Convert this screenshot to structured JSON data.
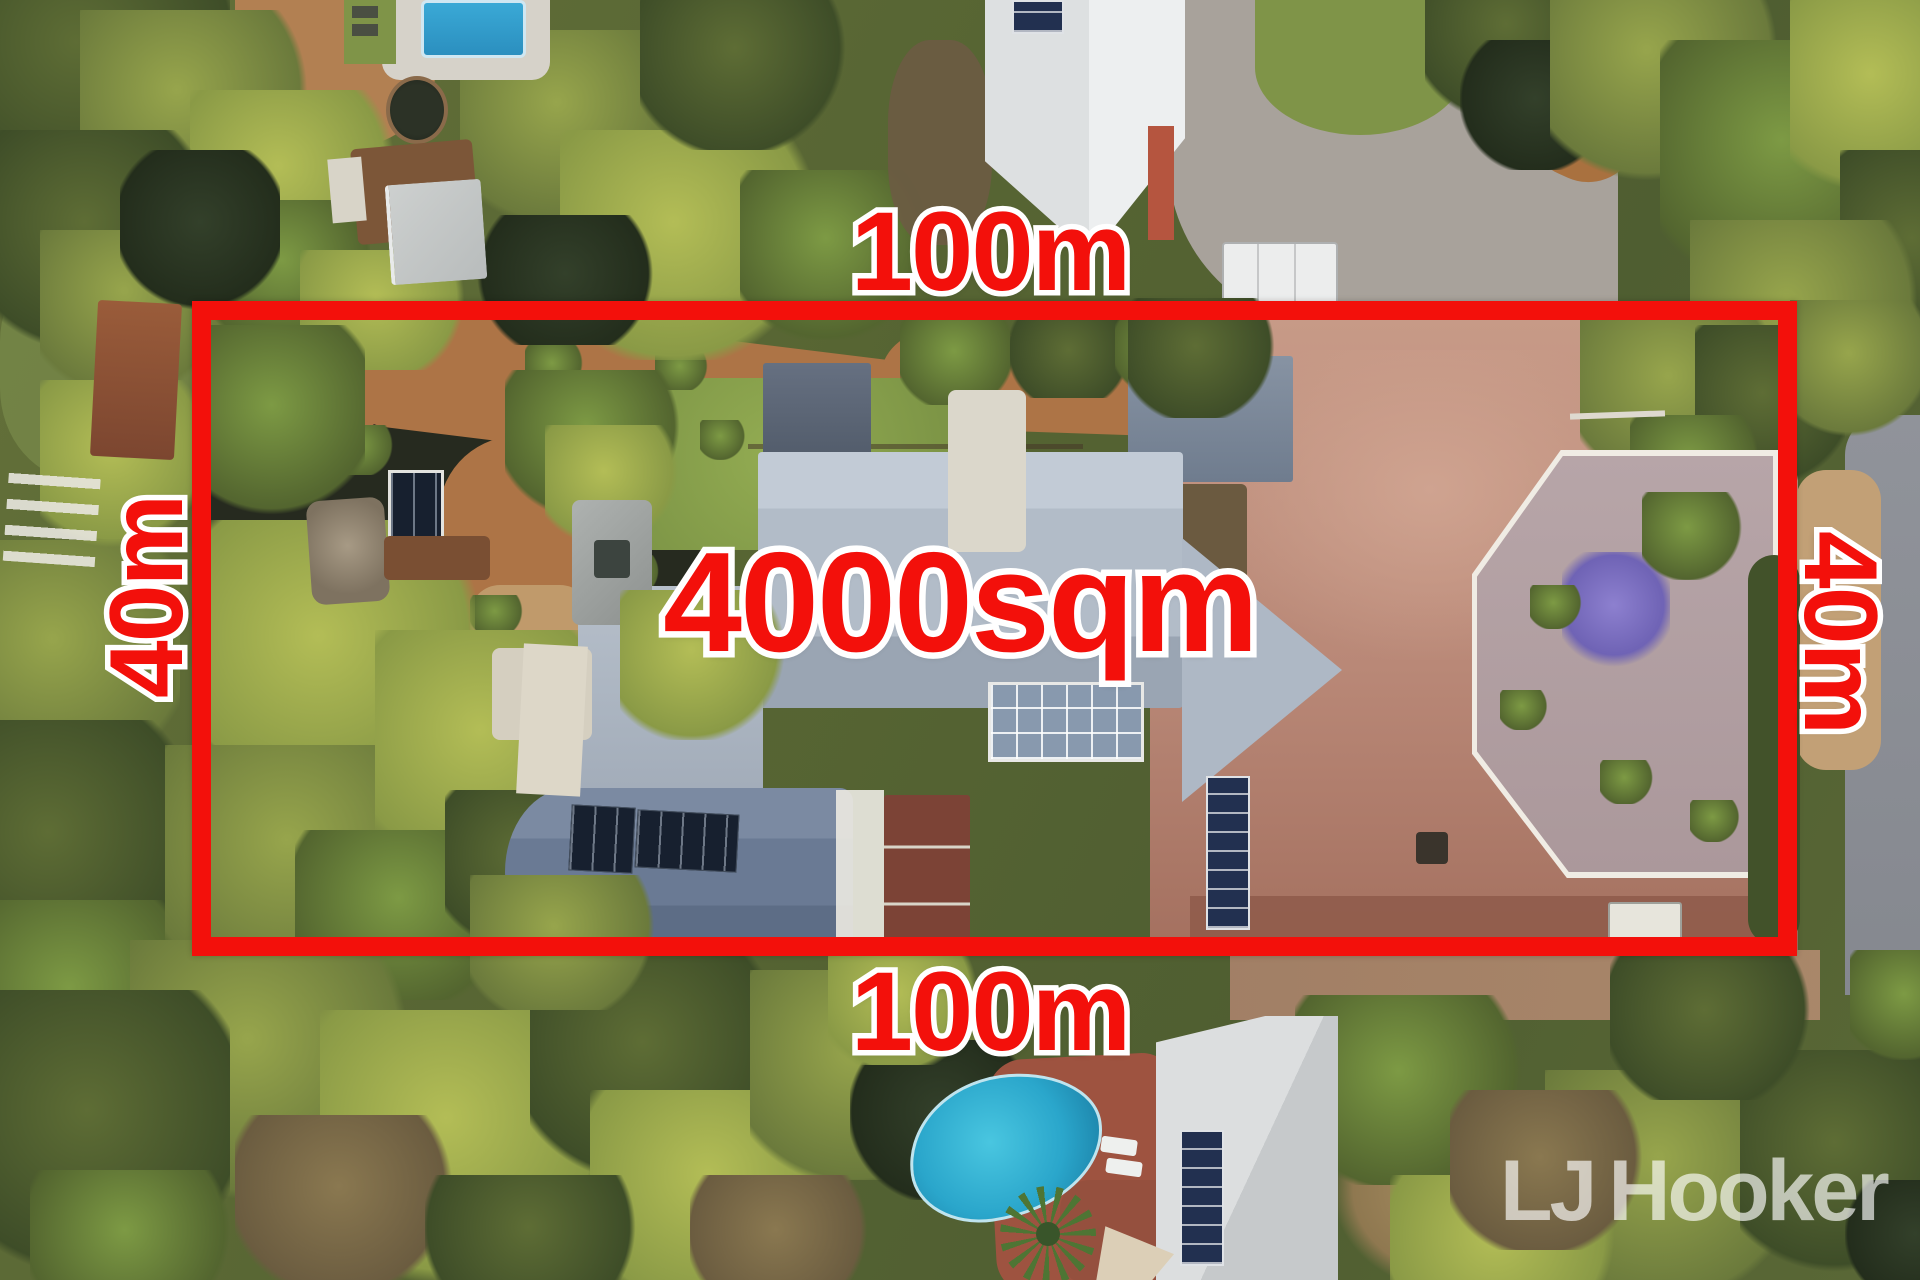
{
  "annotations": {
    "area_label": "4000sqm",
    "top_width_label": "100m",
    "bottom_width_label": "100m",
    "left_depth_label": "40m",
    "right_depth_label": "40m",
    "accent_color": "#f3100b",
    "outline_color": "#ffffff"
  },
  "watermark": {
    "prefix": "LJ",
    "name": "Hooker"
  }
}
